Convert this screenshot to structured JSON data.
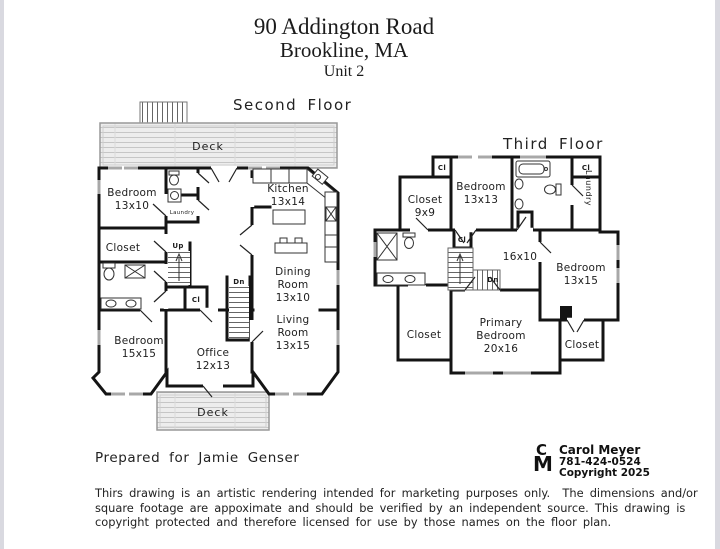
{
  "header": {
    "line1": "90 Addington Road",
    "line2": "Brookline, MA",
    "line3": "Unit 2"
  },
  "sf": {
    "label": "Second Floor",
    "deck_top": "Deck",
    "deck_bottom": "Deck",
    "bedroom1": "Bedroom",
    "bedroom1_d": "13x10",
    "closet": "Closet",
    "laundry": "Laundry",
    "up": "Up",
    "cl": "Cl",
    "dn": "Dn",
    "kitchen": "Kitchen",
    "kitchen_d": "13x14",
    "dining1": "Dining",
    "dining2": "Room",
    "dining3": "13x10",
    "living1": "Living",
    "living2": "Room",
    "living3": "13x15",
    "bedroom2": "Bedroom",
    "bedroom2_d": "15x15",
    "office": "Office",
    "office_d": "12x13"
  },
  "tf": {
    "label": "Third Floor",
    "closet9": "Closet",
    "closet9_d": "9x9",
    "bedroom13": "Bedroom",
    "bedroom13_d": "13x13",
    "cl1": "Cl",
    "cl2": "Cl",
    "cl3": "Cl",
    "laundry": "Laundry",
    "hall_d": "16x10",
    "dn": "Dn",
    "bedroom15": "Bedroom",
    "bedroom15_d": "13x15",
    "primary1": "Primary",
    "primary2": "Bedroom",
    "primary3": "20x16",
    "closetL": "Closet",
    "closetR": "Closet"
  },
  "footer": {
    "prepared_for": "Prepared for Jamie Genser",
    "logo": {
      "letter1": "C",
      "letter2": "M",
      "name": "Carol Meyer",
      "phone": "781-424-0524",
      "copyright": "Copyright 2025"
    },
    "disclaimer1": "Thirs drawing is an artistic rendering intended for marketing purposes only.  The dimensions and/or",
    "disclaimer2": "square footage are appoximate and should be verified by an independent source. This drawing is",
    "disclaimer3": "copyright protected and therefore licensed for use by those names on the floor plan."
  },
  "colors": {
    "wall": "#141414",
    "window": "#a8a8a8",
    "deck_fill": "#ededed",
    "deck_line": "#c6c6c6"
  }
}
